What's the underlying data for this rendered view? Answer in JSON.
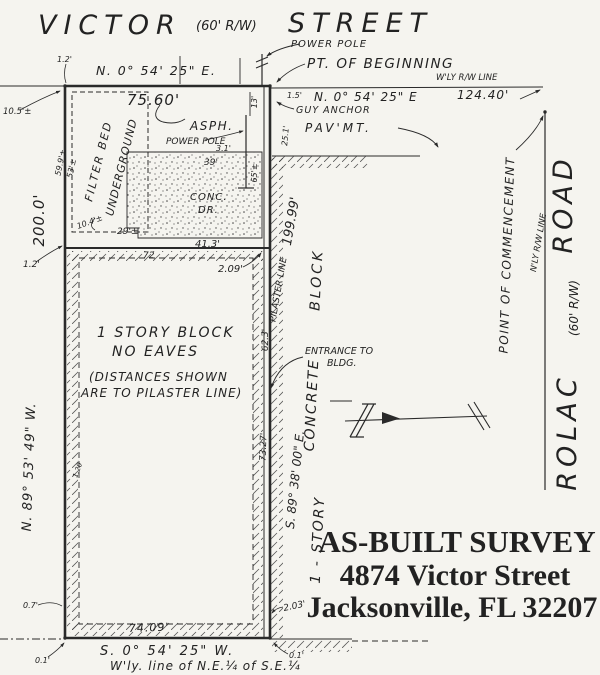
{
  "colors": {
    "paper": "#f5f4ef",
    "ink": "#2a2a2a"
  },
  "victor_street": {
    "name": "VICTOR",
    "rw": "(60' R/W)",
    "type": "STREET"
  },
  "rolac_road": {
    "name": "ROLAC",
    "rw": "(60' R/W)",
    "type": "ROAD"
  },
  "title_block": {
    "line1": "AS-BUILT SURVEY",
    "line2": "4874 Victor Street",
    "line3": "Jacksonville, FL 32207"
  },
  "boundary": {
    "top_bearing": "N. 0° 54' 25\" E.",
    "top_right_bearing": "N. 0° 54' 25\" E",
    "top_right_dist": "124.40'",
    "front_dim": "75.60'",
    "left_dist": "200.0'",
    "left_bearing": "N. 89° 53' 49\" W.",
    "right_dist": "199.99'",
    "right_bearing": "S. 89° 38' 00\" E.",
    "bottom_dist": "74.09'",
    "bottom_bearing": "S. 0° 54' 25\" W."
  },
  "annotations": {
    "power_pole": "POWER POLE",
    "pob": "PT. OF BEGINNING",
    "wly_rw_line": "W'LY R/W LINE",
    "nly_rw_line": "N'LY R/W LINE",
    "guy_anchor": "GUY ANCHOR",
    "pavement": "PAV'MT.",
    "asphalt": "ASPH.",
    "power_pole_2": "POWER POLE",
    "filter_bed_line1": "FILTER BED",
    "filter_bed_line2": "UNDERGROUND",
    "conc_line1": "CONC.",
    "conc_line2": "DR.",
    "building_line1": "1 STORY BLOCK",
    "building_line2": "NO EAVES",
    "note_line1": "(DISTANCES SHOWN",
    "note_line2": "ARE TO PILASTER LINE)",
    "pilaster_line": "PILASTER LINE",
    "wall_line1": "1 - STORY",
    "wall_line2": "CONCRETE",
    "wall_line3": "BLOCK",
    "entrance_line1": "ENTRANCE TO",
    "entrance_line2": "BLDG.",
    "poc": "POINT OF COMMENCEMENT",
    "quarter_line": "W'ly. line of N.E.¼ of S.E.¼"
  },
  "dims": {
    "d_12a": "1.2'",
    "d_105": "10.5'±",
    "d_599": "59.9'±",
    "d_53": "53'±",
    "d_104": "10.4'±",
    "d_29": "29'±",
    "d_12b": "1.2'",
    "d_13": "13'",
    "d_15": "1.5'",
    "d_31": "3.1'",
    "d_39": "39'",
    "d_65": "65'±",
    "d_251": "25.1'",
    "d_413": "41.3'",
    "d_72": "72",
    "d_209": "2.09'",
    "d_623": "62.3'",
    "d_7327": "73.27'",
    "d_203": "2.03'",
    "d_07": "0.7'",
    "d_01a": "0.1'",
    "d_01b": "0.1'",
    "d_120": "1.20'"
  }
}
